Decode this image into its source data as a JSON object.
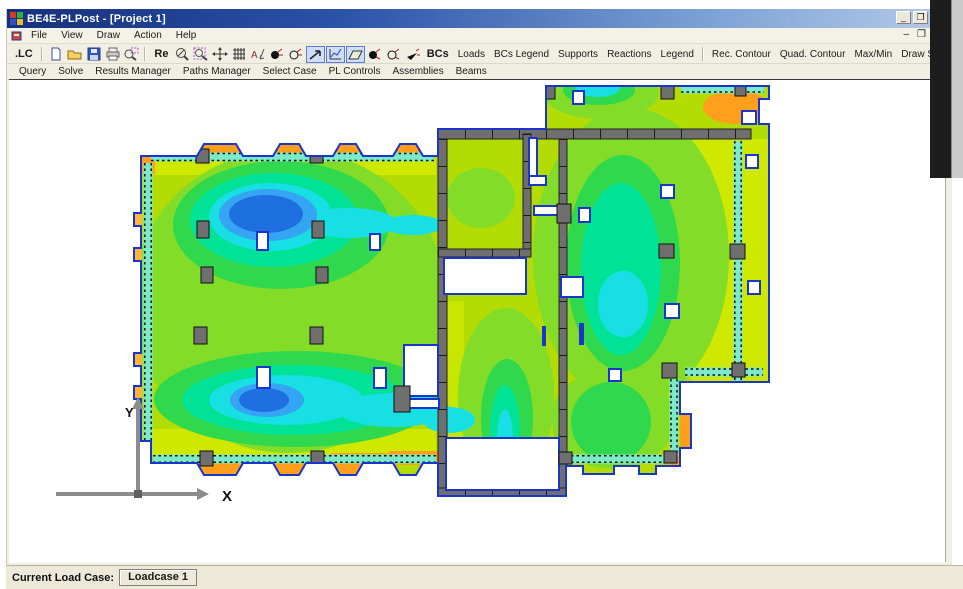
{
  "window": {
    "title": "BE4E-PLPost - [Project 1]"
  },
  "menu": {
    "items": [
      "File",
      "View",
      "Draw",
      "Action",
      "Help"
    ]
  },
  "toolbar_main": {
    "lc": ".LC",
    "re": "Re",
    "bcs": "BCs",
    "dim_icon_letter": "A",
    "text_buttons": [
      "Loads",
      "BCs Legend",
      "Supports",
      "Reactions",
      "Legend",
      "Rec. Contour",
      "Quad. Contour",
      "Max/Min",
      "Draw Strip"
    ]
  },
  "toolbar_secondary": {
    "buttons": [
      "Query",
      "Solve",
      "Results Manager",
      "Paths Manager",
      "Select Case",
      "PL Controls",
      "Assemblies",
      "Beams"
    ]
  },
  "status_bar": {
    "label": "Current Load Case:",
    "value": "Loadcase 1"
  },
  "plot": {
    "axis_x": "X",
    "axis_y": "Y",
    "palette": {
      "max_deflection_blue": "#1e6fe0",
      "high_blue": "#35a4f2",
      "cyan": "#18dfe3",
      "spring_green": "#00e295",
      "green": "#2fd84d",
      "light_green": "#83dd28",
      "base_yellow_green": "#b3db04",
      "yellow": "#cfe800",
      "edge_orange": "#ff9f1c",
      "wall_gray": "#6f6f6f",
      "outline_blue": "#1a35cc",
      "strip_teal": "#7ceac8"
    }
  }
}
